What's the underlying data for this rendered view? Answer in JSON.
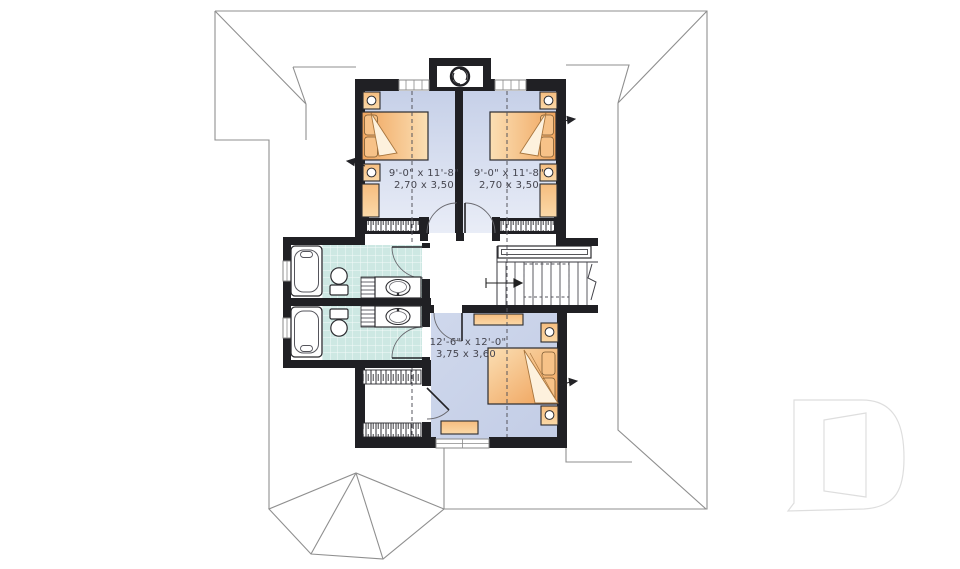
{
  "title": "second-floor-plan",
  "colors": {
    "wall": "#202024",
    "roof_line": "#8f8f8f",
    "bedroom_floor_dark": "#c6d0e8",
    "bedroom_floor_light": "#e9edf7",
    "tile": "#cde8e3",
    "tile_grout": "#f3faf8",
    "furniture_orange_dark": "#f0a55e",
    "furniture_orange_light": "#fbdfb4",
    "label_text": "#45454f",
    "logo_line": "#dedede"
  },
  "rooms": {
    "bedroom1": {
      "name": "bedroom-1",
      "imperial": "9'-0\" x 11'-8\"",
      "metric": "2,70 x 3,50"
    },
    "bedroom2": {
      "name": "bedroom-2",
      "imperial": "9'-0\" x 11'-8\"",
      "metric": "2,70 x 3,50"
    },
    "bedroom3": {
      "name": "bedroom-3",
      "imperial": "12'-6\" x 12'-0\"",
      "metric": "3,75 x 3,60"
    },
    "bathroom1": {
      "name": "bathroom-top"
    },
    "bathroom2": {
      "name": "bathroom-bottom"
    },
    "walkin": {
      "name": "walk-in-closet"
    },
    "hallway": {
      "name": "hallway-landing"
    },
    "stairs": {
      "name": "staircase"
    }
  },
  "fixtures": [
    "bathtub",
    "toilet",
    "vanity-sink",
    "linen-shelves",
    "bed",
    "pillow",
    "nightstand-lamp",
    "dresser",
    "closet-hanging-rod",
    "stair-treads",
    "stair-direction-arrow",
    "round-dormer-window",
    "window",
    "door-swing",
    "section-line",
    "roof-outline",
    "turret-roof"
  ],
  "logo": {
    "name": "builder-logo-D"
  }
}
